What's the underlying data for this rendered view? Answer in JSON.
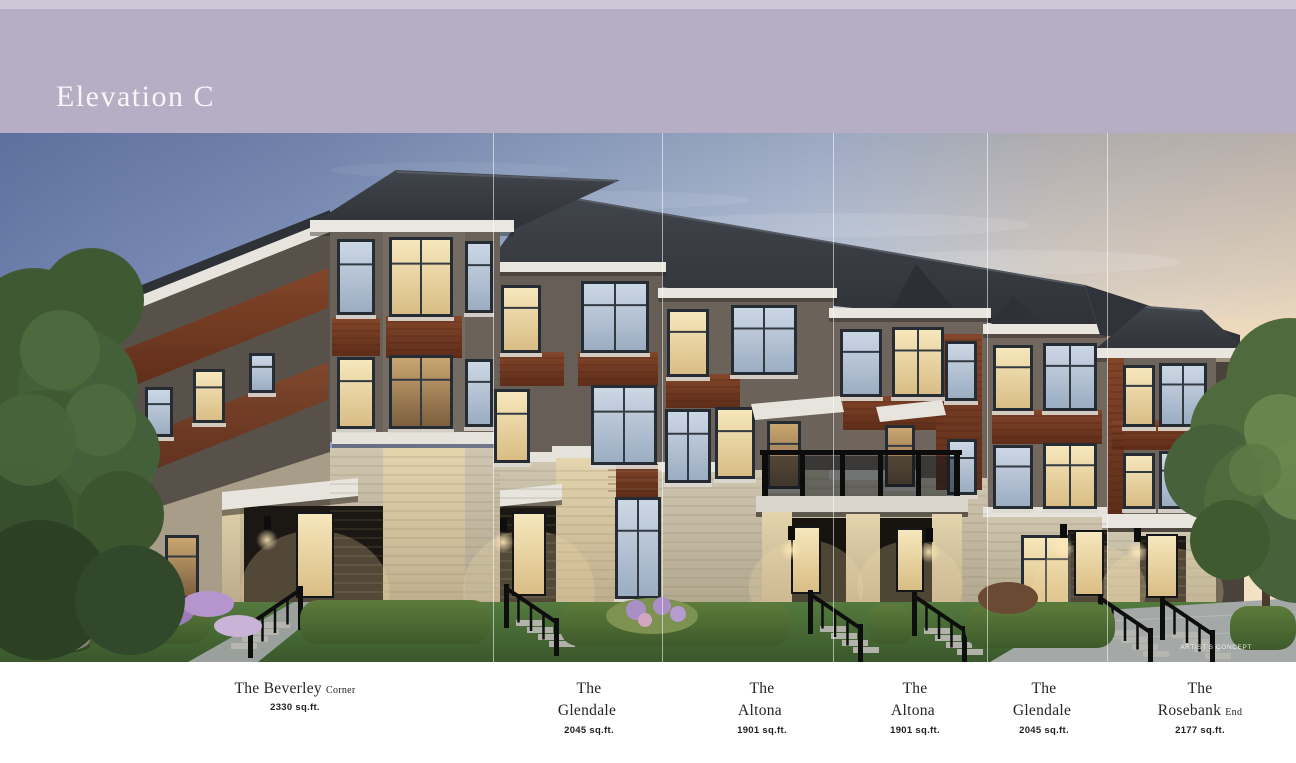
{
  "banner": {
    "title": "Elevation C"
  },
  "image": {
    "caption": "ARTIST'S CONCEPT"
  },
  "units": [
    {
      "article": "The",
      "name": "Beverley",
      "suffix": "Corner",
      "area": "2330 sq.ft."
    },
    {
      "article": "The",
      "name": "Glendale",
      "suffix": "",
      "area": "2045 sq.ft."
    },
    {
      "article": "The",
      "name": "Altona",
      "suffix": "",
      "area": "1901 sq.ft."
    },
    {
      "article": "The",
      "name": "Altona",
      "suffix": "",
      "area": "1901 sq.ft."
    },
    {
      "article": "The",
      "name": "Glendale",
      "suffix": "",
      "area": "2045 sq.ft."
    },
    {
      "article": "The",
      "name": "Rosebank",
      "suffix": "End",
      "area": "2177 sq.ft."
    }
  ],
  "colors": {
    "banner_bg": "#b5aec4",
    "banner_strip": "#cdc7d7",
    "sky_left": "#7386b2",
    "sky_right": "#f4e0c4",
    "roof": "#383b41",
    "brick": "#6b625a",
    "wood_accent": "#7a3e24",
    "stone": "#c6bdaa",
    "trim": "#e9e6e0",
    "railing": "#0e0e0e"
  }
}
